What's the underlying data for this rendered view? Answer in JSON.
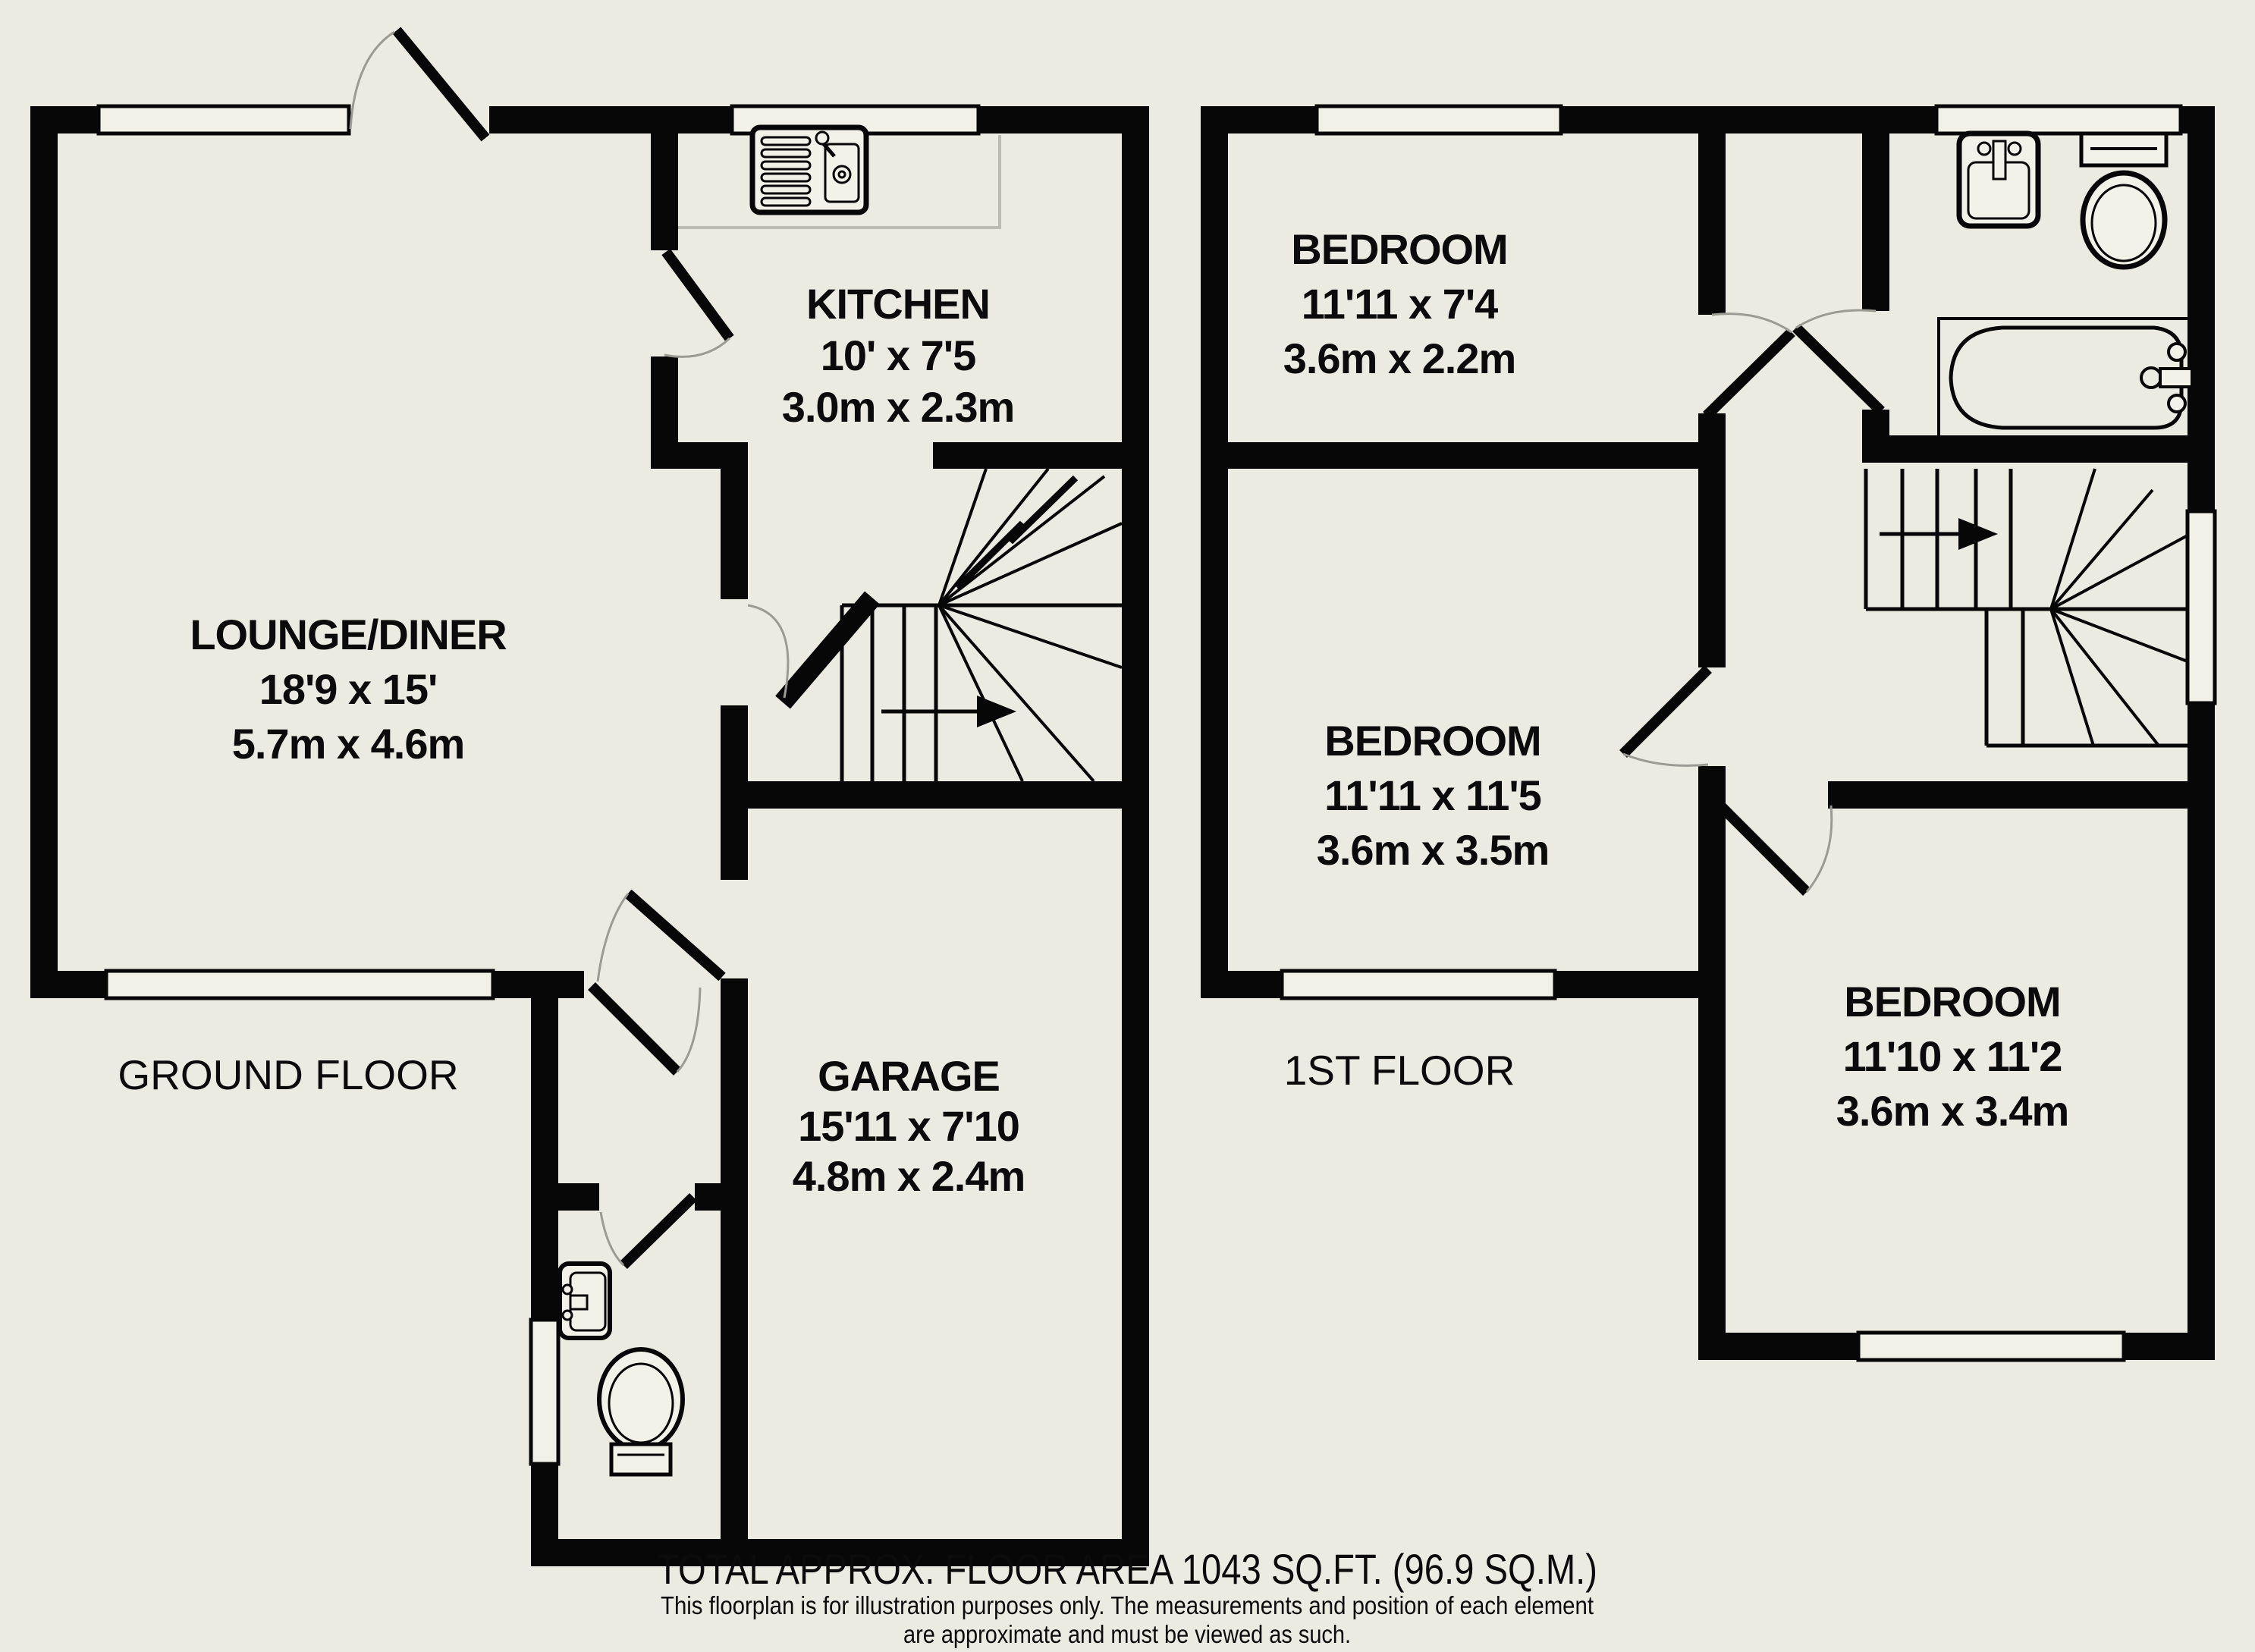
{
  "colors": {
    "background": "#ecebe1",
    "wall": "#070707",
    "door_arc": "#9b9b93",
    "fixture_fill": "#f3f2e8"
  },
  "ground_floor": {
    "label": "GROUND FLOOR",
    "rooms": {
      "lounge": {
        "name": "LOUNGE/DINER",
        "imperial": "18'9 x 15'",
        "metric": "5.7m x 4.6m"
      },
      "kitchen": {
        "name": "KITCHEN",
        "imperial": "10' x 7'5",
        "metric": "3.0m x 2.3m"
      },
      "garage": {
        "name": "GARAGE",
        "imperial": "15'11 x 7'10",
        "metric": "4.8m x 2.4m"
      }
    }
  },
  "first_floor": {
    "label": "1ST FLOOR",
    "rooms": {
      "bedroom1": {
        "name": "BEDROOM",
        "imperial": "11'11 x 7'4",
        "metric": "3.6m x 2.2m"
      },
      "bedroom2": {
        "name": "BEDROOM",
        "imperial": "11'11 x 11'5",
        "metric": "3.6m x 3.5m"
      },
      "bedroom3": {
        "name": "BEDROOM",
        "imperial": "11'10 x 11'2",
        "metric": "3.6m x 3.4m"
      }
    }
  },
  "footer": {
    "total": "TOTAL APPROX. FLOOR AREA 1043 SQ.FT. (96.9 SQ.M.)",
    "disclaimer1": "This floorplan is for illustration purposes only. The measurements and position of each element",
    "disclaimer2": "are approximate and must be viewed as such."
  }
}
